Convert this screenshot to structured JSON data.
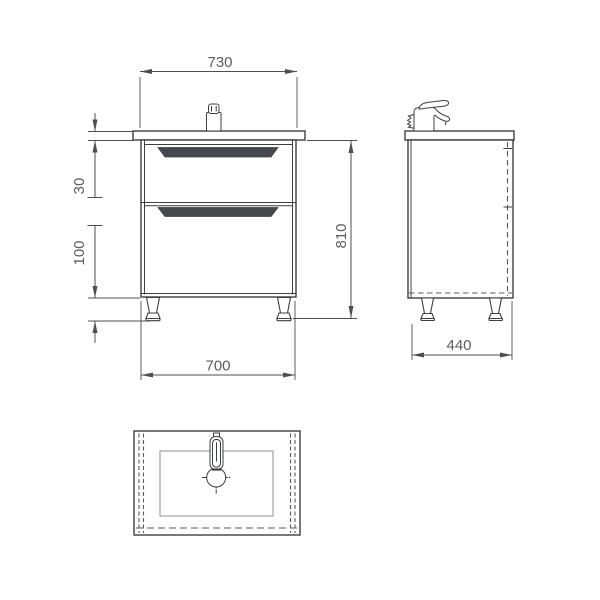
{
  "dimensions": {
    "front_view": {
      "countertop_width": "730",
      "countertop_thickness": "30",
      "leg_height": "100",
      "overall_height": "810",
      "cabinet_width": "700"
    },
    "side_view": {
      "depth": "440"
    }
  },
  "colors": {
    "line": "#3d3f41",
    "dim-line": "#4d4f51",
    "dim-text": "#5a5c5e",
    "handle-fill": "#45484d",
    "hidden-line": "#5a5a5a",
    "basin-line": "#8f8f8f",
    "background": "#ffffff"
  }
}
